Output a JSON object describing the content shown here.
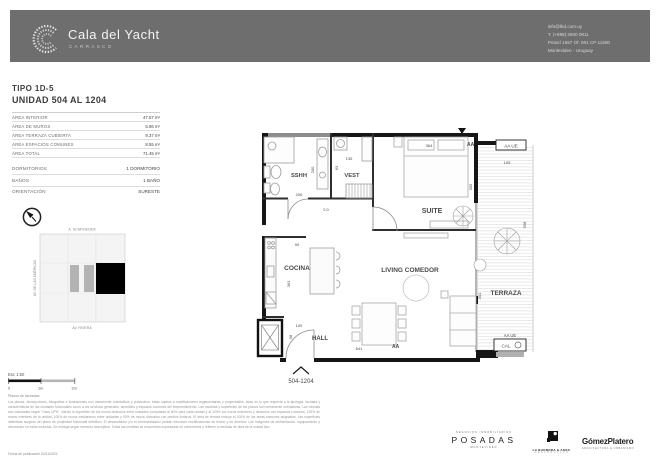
{
  "header": {
    "brand": "Cala del Yacht",
    "brand_sub": "CARRASCO",
    "contact_lines": [
      "info@lbd.com.uy",
      "T. (+598) 2600 0811",
      "Potosí 1557 Of. 001 CP 11500",
      "Montevideo - Uruguay"
    ]
  },
  "unit": {
    "tipo": "TIPO 1D-5",
    "unidad": "UNIDAD 504 AL 1204",
    "areas": [
      {
        "label": "ÁREA INTERIOR",
        "value": "47.67 m²"
      },
      {
        "label": "ÁREA DE MUROS",
        "value": "5.86 m²"
      },
      {
        "label": "ÁREA TERRAZA CUBIERTA",
        "value": "9.37 m²"
      },
      {
        "label": "ÁREA ESPACIOS COMUNES",
        "value": "8.55 m²"
      },
      {
        "label": "ÁREA TOTAL",
        "value": "71.45 m²"
      }
    ],
    "features": [
      {
        "label": "DORMITORIOS",
        "value": "1 DORMITORIO"
      },
      {
        "label": "BAÑOS",
        "value": "1 BAÑO"
      }
    ],
    "orientation": {
      "label": "ORIENTACIÓN",
      "value": "SURESTE"
    }
  },
  "site_map": {
    "street_top": "A. SCHROEDER",
    "street_left": "AV. DE LAS AMÉRICAS",
    "street_bottom": "AV. RIVERA"
  },
  "scale_bar": {
    "label": "Esc 1:50",
    "t0": "0",
    "t1": "1m",
    "t2": "2m"
  },
  "plan": {
    "rooms": {
      "sshh": "SSHH",
      "vest": "VEST",
      "suite": "SUITE",
      "cocina": "COCINA",
      "living": "LIVING COMEDOR",
      "hall": "HALL",
      "terraza": "TERRAZA"
    },
    "dims": {
      "suite_w": "364",
      "suite_h": "305",
      "terr_w": "105",
      "terr_h": "558",
      "terr_low": "301",
      "vest_w": "135",
      "vest_h": "63",
      "sshh_h": "200",
      "sshh_w": "206",
      "misc": "2.0",
      "kitchen_w": "90",
      "kitchen_h": "361",
      "hall_w": "100",
      "hall_h": "98",
      "living_w": "641"
    },
    "markers": {
      "aa_top": "AA",
      "aa_bottom": "AA",
      "aa_ue_top": "AA UE",
      "aa_ue_bottom": "AA UE",
      "cal": "CAL",
      "unit_range": "504-1204"
    }
  },
  "footer": {
    "note_title": "Planos de fachadas",
    "disclaimer": "Los planos, descripciones, fotografías e ilustraciones son meramente orientativos y provisorios, están sujetos a modificaciones reglamentarias y proyectuales, tanto en lo que respecta a la tipología, fachada y características de las unidades funcionales como a los servicios generales, amenities y espacios comunes del emprendimiento. Las medidas y superficies de los planos son meramente orientativas. Las mismas son calculadas según \"Usos UPH\", siendo la superficie de los muros divisorios entre unidades computada al 50% para cada unidad y al 100% los muros exteriores y divisorios con espacios comunes; 100% de muros interiores de la unidad, 100% de muros medianeros entre unidades y 50% de muros divisorios con predios linderos. El área de terraza incluye el 100% de las áreas comunes asignadas. Las superficies definitivas surgirán del plano de propiedad horizontal definitivo. El desarrollador y/o el comercializador podrán introducir modificaciones de hecho y de derecho. Las imágenes de ambientación, equipamiento y decoración no están incluidas. Se entrega según memoria descriptiva. Todas las medidas se encuentran expresadas en centímetros y refieren a medidas de obra de la unidad tipo.",
    "pub_date": "Fecha de publicación 02/11/2021",
    "logos": {
      "posadas_top": "NEGOCIOS INMOBILIARIOS",
      "posadas": "POSADAS",
      "posadas_bottom": "MONTEVIDEO",
      "buonora": "LA BUONORA & ASOC.",
      "buonora_sub": "DESARROLLOS",
      "gomez": "GómezPlatero",
      "gomez_sub": "ARQUITECTURA & URBANISMO"
    }
  }
}
